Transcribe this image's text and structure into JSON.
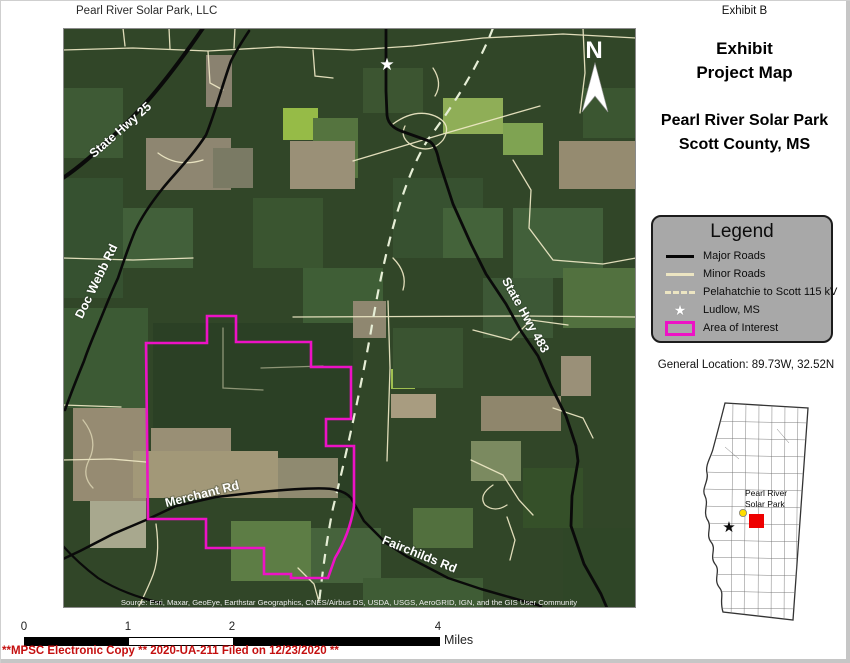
{
  "page": {
    "title_left": "Pearl River Solar Park, LLC",
    "exhibit_tag": "Exhibit B"
  },
  "panel": {
    "heading_line1": "Exhibit",
    "heading_line2": "Project Map",
    "subheading_line1": "Pearl River Solar Park",
    "subheading_line2": "Scott County, MS",
    "general_location": "General Location: 89.73W, 32.52N"
  },
  "legend": {
    "title": "Legend",
    "items": [
      {
        "label": "Major Roads",
        "symbol": "solid-black-line"
      },
      {
        "label": "Minor Roads",
        "symbol": "solid-cream-line"
      },
      {
        "label": "Pelahatchie to Scott 115 kV",
        "symbol": "dashed-cream-line"
      },
      {
        "label": "Ludlow, MS",
        "symbol": "white-star"
      },
      {
        "label": "Area of Interest",
        "symbol": "magenta-rectangle"
      }
    ]
  },
  "map": {
    "north_label": "N",
    "road_labels": {
      "hwy25": "State Hwy 25",
      "docwebb": "Doc Webb Rd",
      "hwy483": "State Hwy 483",
      "merchant": "Merchant Rd",
      "fairchilds": "Fairchilds Rd"
    },
    "attribution": "Source: Esri, Maxar, GeoEye, Earthstar Geographics, CNES/Airbus DS, USDA, USGS, AeroGRID, IGN, and the GIS User Community"
  },
  "inset": {
    "label_line1": "Pearl River",
    "label_line2": "Solar Park"
  },
  "scalebar": {
    "ticks": [
      "0",
      "1",
      "2",
      "4"
    ],
    "unit": "Miles"
  },
  "footer": {
    "filing_text": "**MPSC Electronic Copy ** 2020-UA-211 Filed on 12/23/2020 **"
  },
  "colors": {
    "aoi_magenta": "#ed12c6",
    "major_road": "#0a0a0a",
    "minor_road": "#efe9c6",
    "transmission_dash": "#e6eed6",
    "legend_background": "#a8a8a8",
    "filing_red": "#c40f0f",
    "inset_highlight_red": "#ee0000",
    "inset_dot_yellow": "#ffdd00"
  }
}
